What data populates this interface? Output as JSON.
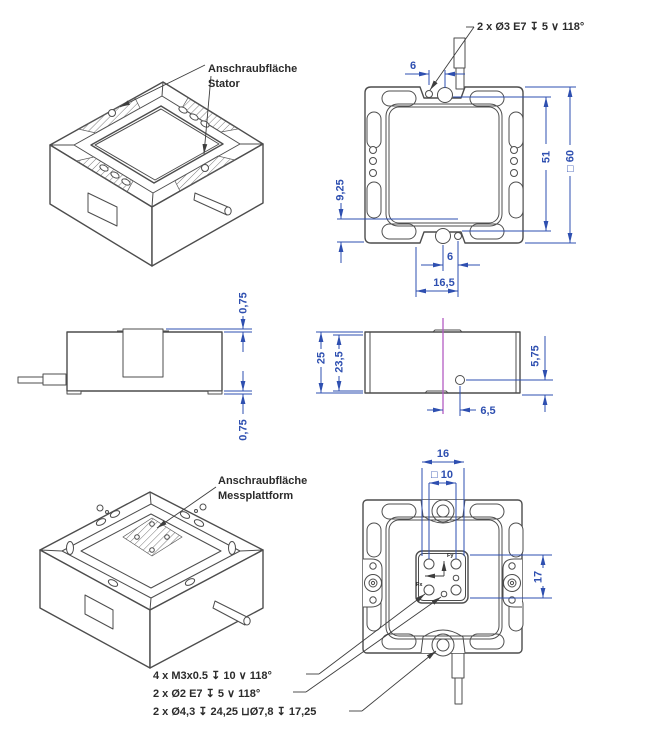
{
  "drawing": {
    "colors": {
      "geometry": "#4d4d4d",
      "dimension": "#2e4fb0",
      "centerline": "#b45cc4",
      "background": "#ffffff"
    },
    "labels": {
      "stator": [
        "Anschraubfläche",
        "Stator"
      ],
      "platform": [
        "Anschraubfläche",
        "Messplattform"
      ]
    },
    "callouts": {
      "top_hole": "2 x Ø3 E7 ↧ 5 ∨ 118°",
      "thread": "4 x M3x0.5 ↧ 10 ∨ 118°",
      "pin_hole": "2 x Ø2 E7 ↧ 5 ∨ 118°",
      "counterbore": "2 x Ø4,3 ↧ 24,25 ⊔Ø7,8 ↧ 17,25"
    },
    "axes": {
      "x": "Fx",
      "y": "Fy"
    },
    "dims": {
      "top_view": {
        "pin_offset_top": "6",
        "hole_spacing": "51",
        "outer_square": "□ 60",
        "edge_offset": "9,25",
        "pin_offset_bottom": "6",
        "notch_width": "16,5"
      },
      "side_left": {
        "top_protrusion": "0,75",
        "bottom_protrusion": "0,75"
      },
      "side_right": {
        "height": "25",
        "inner_height": "23,5",
        "cable_height": "5,75",
        "cable_offset": "6,5"
      },
      "bottom_view": {
        "platform_width": "16",
        "thread_square": "□ 10",
        "platform_height": "17"
      }
    }
  }
}
